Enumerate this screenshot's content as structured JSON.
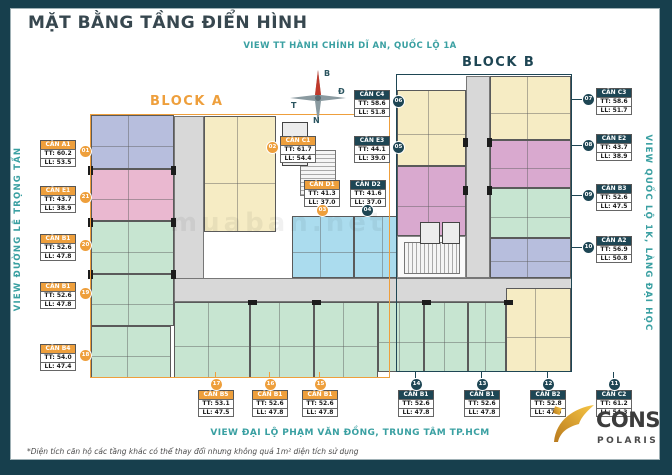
{
  "title": "MẶT BẰNG TẦNG ĐIỂN HÌNH",
  "subtitle_top": "VIEW TT HÀNH CHÍNH DĨ AN, QUỐC LỘ 1A",
  "side_left": "VIEW ĐƯỜNG LÊ TRỌNG TẤN",
  "side_right": "VIEW QUỐC LỘ 1K, LÀNG ĐẠI HỌC",
  "bottom_view": "VIEW ĐẠI LỘ PHẠM VĂN ĐỒNG, TRUNG TÂM TP.HCM",
  "footnote": "*Diện tích căn hộ các tầng khác có thể thay đổi nhưng không quá 1m² diện tích sử dụng",
  "watermark": "muaban.net",
  "blocks": {
    "a": "BLOCK A",
    "b": "BLOCK B"
  },
  "compass": {
    "north": "B",
    "east": "Đ",
    "west": "T",
    "south": "N"
  },
  "logo": {
    "brand": "CONS",
    "sub": "POLARIS"
  },
  "colors": {
    "bgDark": "#173f4d",
    "title": "#37474f",
    "teal": "#3aa0a2",
    "orange": "#ee9f3c",
    "dark": "#1e4654",
    "lavender": "#b7bedd",
    "pink": "#eab8d0",
    "magenta": "#d9a9cf",
    "green": "#c7e5d1",
    "yellow": "#f6ecc4",
    "cyan": "#abdcee",
    "corridor": "#d8d8d8",
    "gold": "#e6a93a"
  },
  "units": [
    {
      "name": "CĂN A1",
      "tt": "TT: 60.2",
      "ll": "LL: 53.5",
      "badge": "01",
      "block": "A"
    },
    {
      "name": "CĂN E1",
      "tt": "TT: 43.7",
      "ll": "LL: 38.9",
      "badge": "21",
      "block": "A"
    },
    {
      "name": "CĂN B1",
      "tt": "TT: 52.6",
      "ll": "LL: 47.8",
      "badge": "20",
      "block": "A"
    },
    {
      "name": "CĂN B1",
      "tt": "TT: 52.6",
      "ll": "LL: 47.8",
      "badge": "19",
      "block": "A"
    },
    {
      "name": "CĂN B4",
      "tt": "TT: 54.0",
      "ll": "LL: 47.4",
      "badge": "18",
      "block": "A"
    },
    {
      "name": "CĂN B5",
      "tt": "TT: 53.1",
      "ll": "LL: 47.5",
      "badge": "17",
      "block": "A"
    },
    {
      "name": "CĂN B1",
      "tt": "TT: 52.6",
      "ll": "LL: 47.8",
      "badge": "16",
      "block": "A"
    },
    {
      "name": "CĂN B1",
      "tt": "TT: 52.6",
      "ll": "LL: 47.8",
      "badge": "15",
      "block": "A"
    },
    {
      "name": "CĂN C1",
      "tt": "TT: 61.7",
      "ll": "LL: 54.4",
      "badge": "02",
      "block": "A"
    },
    {
      "name": "CĂN D1",
      "tt": "TT: 41.3",
      "ll": "LL: 37.0",
      "badge": "03",
      "block": "A"
    },
    {
      "name": "CĂN D2",
      "tt": "TT: 41.6",
      "ll": "LL: 37.0",
      "badge": "04",
      "block": "B"
    },
    {
      "name": "CĂN C4",
      "tt": "TT: 58.6",
      "ll": "LL: 51.8",
      "badge": "06",
      "block": "B"
    },
    {
      "name": "CĂN E3",
      "tt": "TT: 44.1",
      "ll": "LL: 39.0",
      "badge": "05",
      "block": "B"
    },
    {
      "name": "CĂN C3",
      "tt": "TT: 58.6",
      "ll": "LL: 51.7",
      "badge": "07",
      "block": "B"
    },
    {
      "name": "CĂN E2",
      "tt": "TT: 43.7",
      "ll": "LL: 38.9",
      "badge": "08",
      "block": "B"
    },
    {
      "name": "CĂN B3",
      "tt": "TT: 52.6",
      "ll": "LL: 47.5",
      "badge": "09",
      "block": "B"
    },
    {
      "name": "CĂN A2",
      "tt": "TT: 56.9",
      "ll": "LL: 50.8",
      "badge": "10",
      "block": "B"
    },
    {
      "name": "CĂN B1",
      "tt": "TT: 52.6",
      "ll": "LL: 47.8",
      "badge": "14",
      "block": "B"
    },
    {
      "name": "CĂN B1",
      "tt": "TT: 52.6",
      "ll": "LL: 47.8",
      "badge": "13",
      "block": "B"
    },
    {
      "name": "CĂN B2",
      "tt": "TT: 52.8",
      "ll": "LL: 47.9",
      "badge": "12",
      "block": "B"
    },
    {
      "name": "CĂN C2",
      "tt": "TT: 61.2",
      "ll": "LL: 54.3",
      "badge": "11",
      "block": "B"
    }
  ]
}
